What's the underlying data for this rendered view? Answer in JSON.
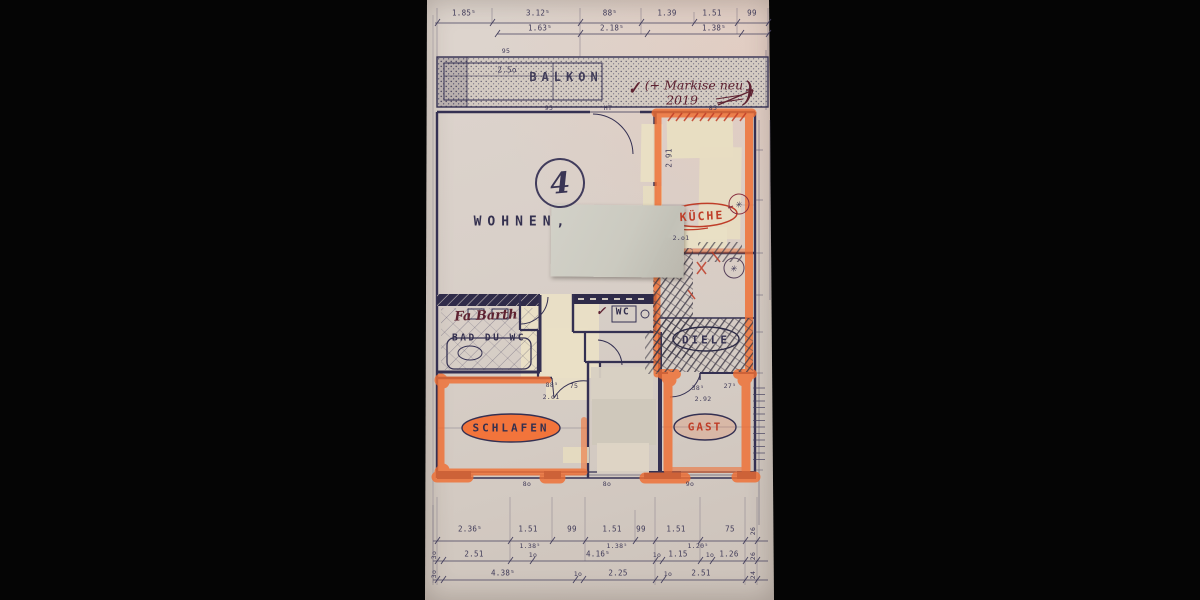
{
  "photo": {
    "apartment_number": "4",
    "rooms": {
      "balkon": "BALKON",
      "wohnen": "WOHNEN,",
      "kueche": "KÜCHE",
      "diele": "DIELE",
      "bad": "BAD DU WC",
      "wc": "WC",
      "schlafen": "SCHLAFEN",
      "gast": "GAST"
    },
    "annotations": {
      "check_top": "✓",
      "note_line1": "(+ Markise neu",
      "note_line2": "2019",
      "note_paren": ")",
      "bath_handwriting": "Fa Barth",
      "wc_check": "✓",
      "kueche_mark": "✳",
      "pantry_mark": "✳"
    },
    "dims": {
      "top_row1": [
        "1.85⁵",
        "3.12⁵",
        "88⁵",
        "1.39",
        "1.51",
        "99"
      ],
      "top_row2": [
        "1.63⁵",
        "2.18⁵",
        "1.38⁵"
      ],
      "balcony_95a": "95",
      "balcony_250": "2.5o",
      "balcony_95b": "95",
      "ht": "HT",
      "kueche_top": "85",
      "kueche_left": "2.91",
      "kueche_bottom": "2.o1",
      "mid_885": "88⁵",
      "mid_75": "75",
      "mid_201": "2.o1",
      "gast_385": "38⁵",
      "gast_275": "27⁵",
      "gast_292": "2.92",
      "bottom_row1": [
        "2.36⁵",
        "1.51",
        "99",
        "1.51",
        "99",
        "1.51",
        "75",
        "26"
      ],
      "bottom_row2": [
        "1.38⁵",
        "1.38⁵",
        "1.20⁵"
      ],
      "bottom_row3": [
        "3o",
        "2.51",
        "1o",
        "4.16⁵",
        "1o",
        "1.15",
        "1o",
        "1.26",
        "26"
      ],
      "bottom_row4": [
        "3o",
        "4.38⁵",
        "1o",
        "2.25",
        "1o",
        "2.51",
        "24"
      ],
      "window_row": [
        "8o",
        "8o",
        "9o"
      ]
    },
    "colors": {
      "ink": "#343052",
      "highlight_orange": "#ef6e33",
      "red_pen": "#bf3d28",
      "handwriting": "#5e2231",
      "paper": "#d9d0c8",
      "tape": "#e8dec2",
      "sticky_note": "#cbc9bf"
    }
  }
}
